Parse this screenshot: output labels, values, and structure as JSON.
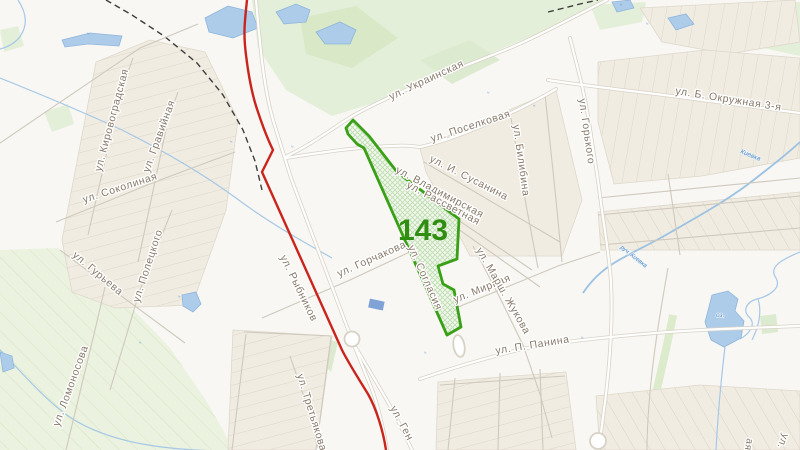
{
  "map": {
    "region": {
      "number": "143",
      "x": 398,
      "y": 240,
      "font_size": 30
    },
    "street_labels": [
      {
        "text": "ул. Кировоградская",
        "x": 101,
        "y": 172,
        "r": -75
      },
      {
        "text": "ул. Соколиная",
        "x": 84,
        "y": 203,
        "r": -18
      },
      {
        "text": "ул. Гравийная",
        "x": 149,
        "y": 173,
        "r": -70
      },
      {
        "text": "ул. Полецкого",
        "x": 139,
        "y": 303,
        "r": -72
      },
      {
        "text": "ул. Гурьева",
        "x": 72,
        "y": 256,
        "r": 40
      },
      {
        "text": "ул. Ломоносова",
        "x": 59,
        "y": 427,
        "r": -70
      },
      {
        "text": "ул. Рыбников",
        "x": 280,
        "y": 257,
        "r": 64
      },
      {
        "text": "ул. Третьякова",
        "x": 297,
        "y": 375,
        "r": 73
      },
      {
        "text": "ул. Ген",
        "x": 390,
        "y": 408,
        "r": 62
      },
      {
        "text": "ул. Украинская",
        "x": 391,
        "y": 100,
        "r": -25
      },
      {
        "text": "ул. Поселковая",
        "x": 432,
        "y": 142,
        "r": -18
      },
      {
        "text": "ул. И. Сусанина",
        "x": 429,
        "y": 161,
        "r": 27
      },
      {
        "text": "ул. Владимирская",
        "x": 395,
        "y": 172,
        "r": 28
      },
      {
        "text": "ул. Рассветная",
        "x": 406,
        "y": 187,
        "r": 28
      },
      {
        "text": "ул. Билибина",
        "x": 513,
        "y": 125,
        "r": 82
      },
      {
        "text": "ул. Горького",
        "x": 579,
        "y": 99,
        "r": 82
      },
      {
        "text": "ул. Б. Окружная 3-я",
        "x": 675,
        "y": 94,
        "r": 9
      },
      {
        "text": "ул. Горчакова",
        "x": 339,
        "y": 277,
        "r": -24
      },
      {
        "text": "ул. Согласия",
        "x": 408,
        "y": 247,
        "r": 66
      },
      {
        "text": "ул. Мирная",
        "x": 455,
        "y": 303,
        "r": -22
      },
      {
        "text": "ул. Марш. Жукова",
        "x": 476,
        "y": 250,
        "r": 60
      },
      {
        "text": "ул. П. Панина",
        "x": 496,
        "y": 354,
        "r": -9
      },
      {
        "text": "ул.",
        "x": 783,
        "y": 433,
        "r": 112,
        "size": 10
      },
      {
        "text": "ая",
        "x": 747,
        "y": 438,
        "r": 100,
        "size": 10
      }
    ],
    "water_labels": [
      {
        "text": "Киевка",
        "x": 740,
        "y": 153,
        "r": 22,
        "size": 6.5
      },
      {
        "text": "руч. Киевка",
        "x": 620,
        "y": 248,
        "r": 38,
        "size": 6
      },
      {
        "text": "оз.",
        "x": 716,
        "y": 317,
        "r": 0,
        "size": 6.5
      }
    ],
    "water_marks": [
      {
        "x": 87,
        "y": 35
      },
      {
        "x": 230,
        "y": 143
      },
      {
        "x": 291,
        "y": 148
      },
      {
        "x": 487,
        "y": 94
      },
      {
        "x": 533,
        "y": 107
      },
      {
        "x": 424,
        "y": 354
      },
      {
        "x": 581,
        "y": 339
      },
      {
        "x": 620,
        "y": 6
      },
      {
        "x": 646,
        "y": 25
      },
      {
        "x": 139,
        "y": 344
      },
      {
        "x": 178,
        "y": 298
      }
    ],
    "colors": {
      "polygon-stroke": "#3aa018",
      "region-number": "#2f8d11",
      "red-route": "#c9251d",
      "street-label": "#87796a",
      "water-label": "#4e86c2",
      "water-fill": "#adcce9",
      "forest-fill": "#e4efd9",
      "block-fill": "#f1ece2"
    }
  }
}
